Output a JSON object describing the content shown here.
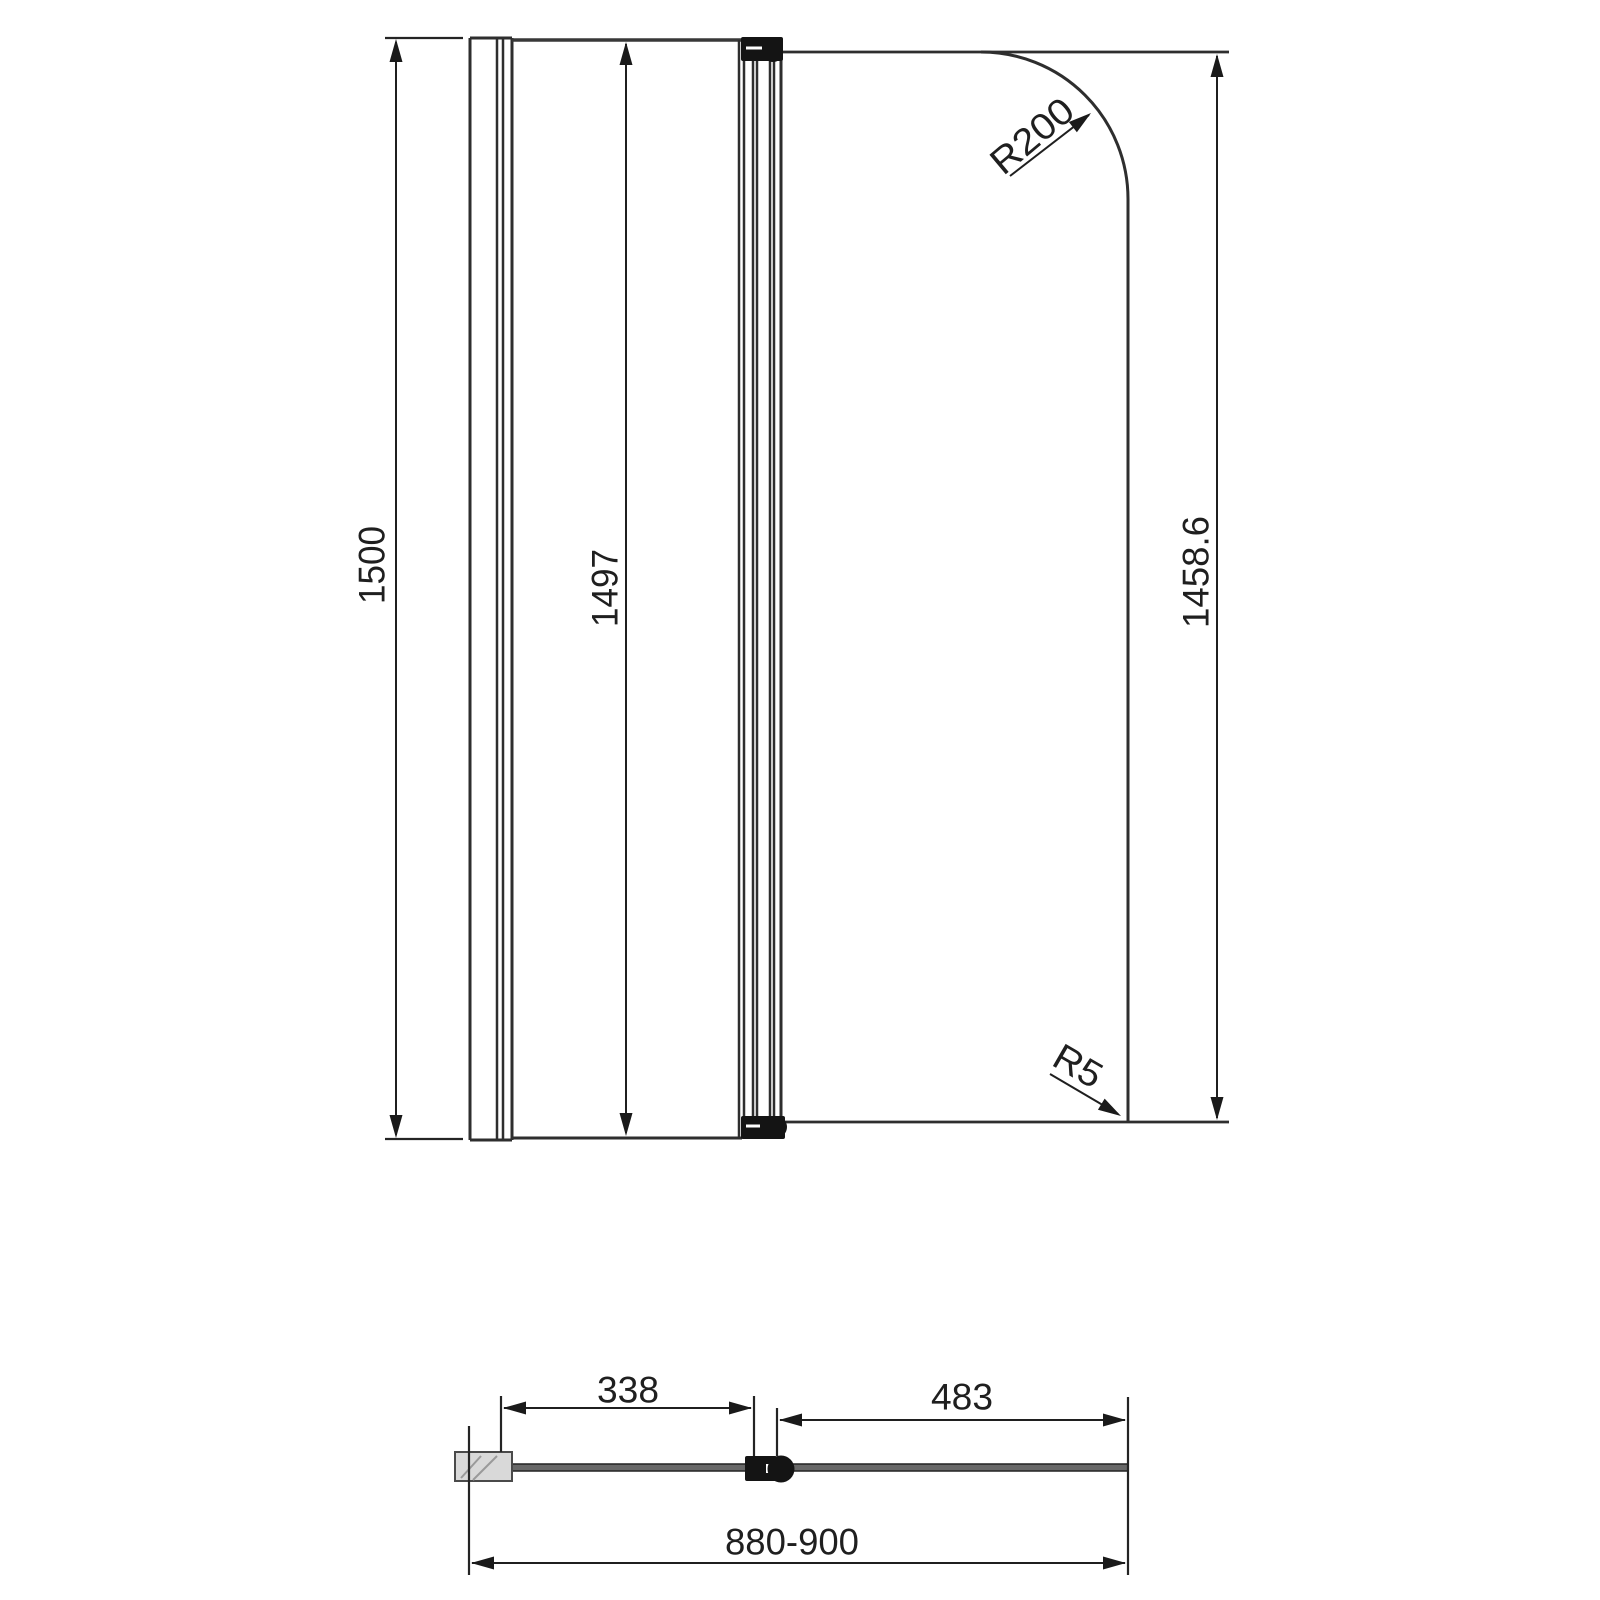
{
  "drawing": {
    "type": "technical-dimension-drawing",
    "subject": "hinged-bath-shower-screen",
    "views": {
      "front_view": {
        "overall_height": "1500",
        "fixed_panel_height": "1497",
        "door_glass_height": "1458.6",
        "top_corner_radius": "R200",
        "bottom_corner_radius": "R5"
      },
      "plan_view": {
        "fixed_panel_width": "338",
        "door_panel_width": "483",
        "overall_width_range": "880-900"
      }
    },
    "colors": {
      "background": "#ffffff",
      "object_line": "#2e2e2e",
      "dimension_line": "#1f1f1f",
      "hinge_fill": "#141414",
      "wall_block_fill": "#d9d9d9",
      "plan_bar_fill": "#686868"
    }
  }
}
